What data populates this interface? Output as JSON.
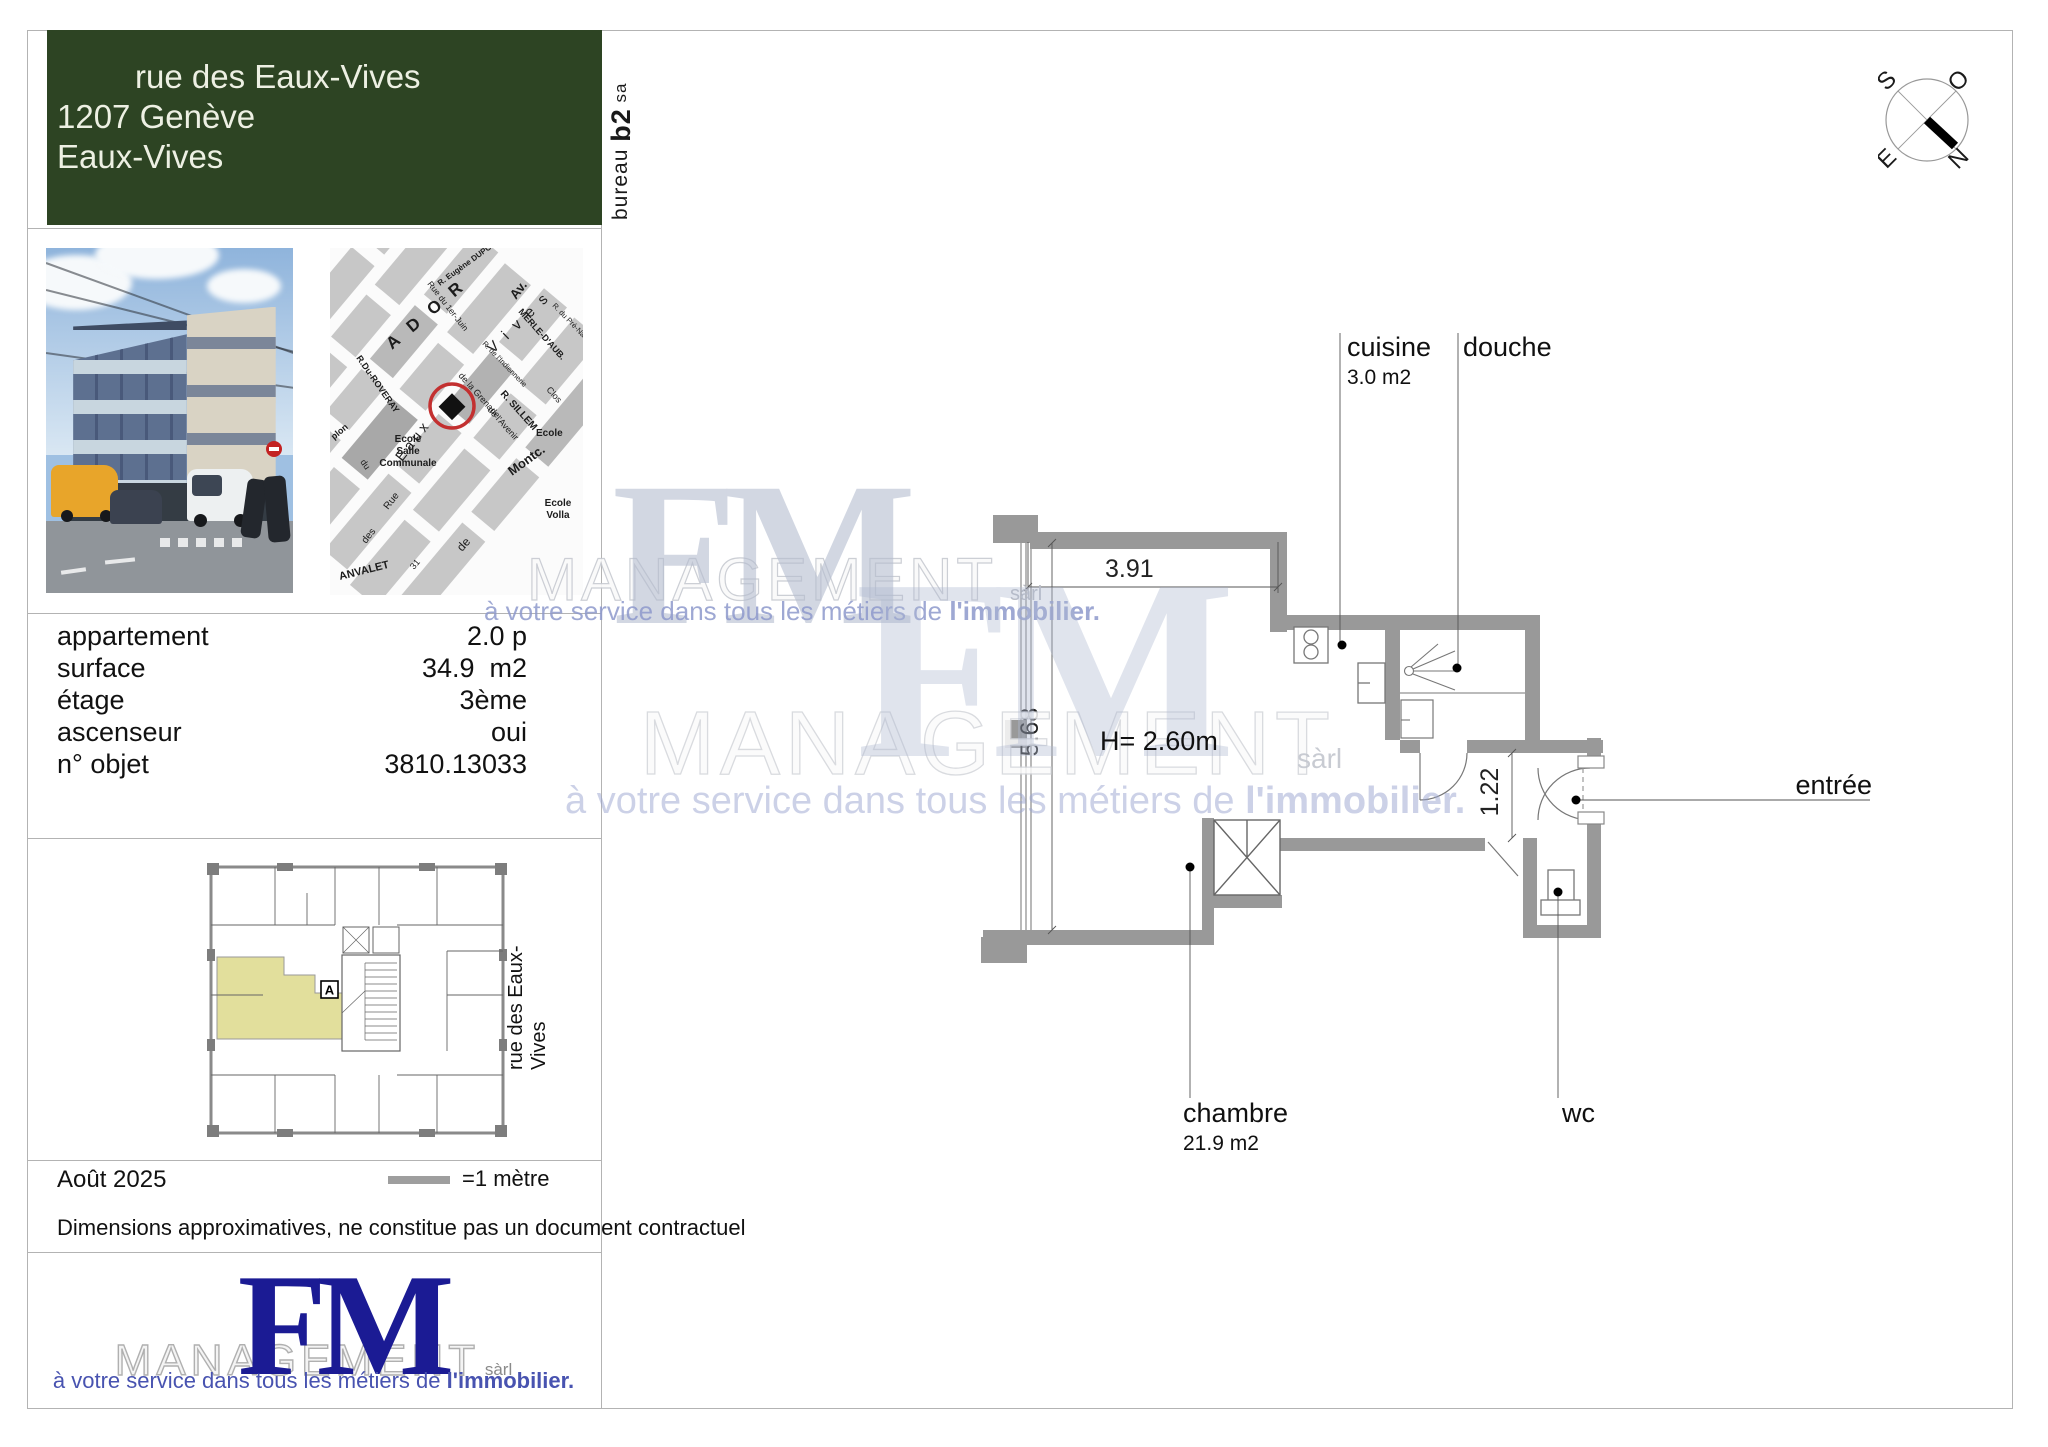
{
  "header": {
    "address_line1": "rue des Eaux-Vives",
    "address_line2": "1207 Genève",
    "address_line3": "Eaux-Vives",
    "bg_color": "#2d4423"
  },
  "side_label": {
    "prefix": "bureau ",
    "bold": "b2",
    "suffix": " sa"
  },
  "details": {
    "rows": [
      {
        "label": "appartement",
        "value": "2.0 p"
      },
      {
        "label": "surface",
        "value": "34.9  m2"
      },
      {
        "label": "étage",
        "value": "3ème"
      },
      {
        "label": "ascenseur",
        "value": "oui"
      },
      {
        "label": "n° objet",
        "value": "3810.13033"
      }
    ]
  },
  "map": {
    "streets": [
      "A D O R",
      "Av.",
      "V i v e s",
      "R. Eugène DUPONT",
      "Rue du 1er-Juin",
      "MERLE-D'AUB.",
      "R. de l'Indiennerie",
      "R. du Pré-Navi",
      "R. SILLEM",
      "Clos",
      "Montc.",
      "R.Du-ROVERAY",
      "Eaux",
      "de la Grenade",
      "de l'Avenir",
      "ANVALET",
      "Rue",
      "des",
      "de",
      "du",
      "31",
      "plon"
    ],
    "poi": [
      "Ecole",
      "Salle",
      "Communale",
      "Ecole",
      "Volla",
      "Ecole"
    ],
    "marker_color": "#c33030"
  },
  "overview_plan": {
    "street_label": "rue des Eaux-Vives",
    "unit_label": "A",
    "highlight_color": "#e2df9c"
  },
  "footer": {
    "date": "Août 2025",
    "scale_label": "=1 mètre",
    "disclaimer": "Dimensions approximatives, ne constitue pas un document contractuel"
  },
  "logo": {
    "fm": "FM",
    "management": "MANAGEMENT",
    "suffix": "sàrl",
    "tagline_normal": "à votre service dans tous les métiers de ",
    "tagline_bold": "l'immobilier.",
    "fm_color": "#1b1b94",
    "tagline_color": "#4853b0"
  },
  "floor_plan": {
    "rooms": [
      {
        "name": "cuisine",
        "area": "3.0 m2"
      },
      {
        "name": "douche",
        "area": ""
      },
      {
        "name": "entrée",
        "area": ""
      },
      {
        "name": "chambre",
        "area": "21.9 m2"
      },
      {
        "name": "wc",
        "area": ""
      }
    ],
    "height_label": "H= 2.60m",
    "dimensions": {
      "width": "3.91",
      "depth": "5.68",
      "hall": "1.22"
    },
    "wall_color": "#999999"
  },
  "compass": {
    "top_left": "S",
    "top_right": "O",
    "bottom_left": "E",
    "bottom_right": "N"
  }
}
